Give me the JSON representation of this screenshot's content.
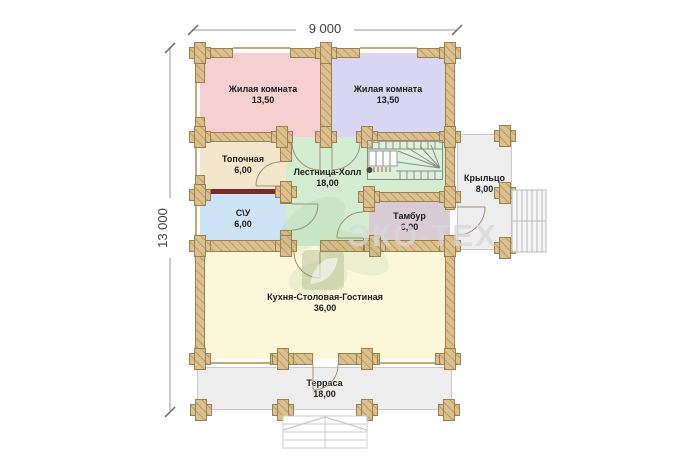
{
  "dimensions": {
    "width": "9 000",
    "height": "13 000"
  },
  "watermark": {
    "brand": "ЭКО-ТЕХ"
  },
  "rooms": [
    {
      "id": "bedroom-left",
      "name": "Жилая комната",
      "area": "13,50",
      "color": "#f6cfd1"
    },
    {
      "id": "bedroom-right",
      "name": "Жилая комната",
      "area": "13,50",
      "color": "#d9d6f3"
    },
    {
      "id": "boiler",
      "name": "Топочная",
      "area": "6,00",
      "color": "#f3e7cb"
    },
    {
      "id": "hall",
      "name": "Лестница-Холл",
      "area": "18,00",
      "color": "#d2edd0"
    },
    {
      "id": "bathroom",
      "name": "С\\У",
      "area": "6,00",
      "color": "#cde4f7"
    },
    {
      "id": "tambour",
      "name": "Тамбур",
      "area": "6,00",
      "color": "#d8cbd2"
    },
    {
      "id": "kitchen",
      "name": "Кухня-Столовая-Гостиная",
      "area": "36,00",
      "color": "#faf8d8"
    },
    {
      "id": "porch",
      "name": "Крыльцо",
      "area": "8,00",
      "color": "#ededed"
    },
    {
      "id": "terrace",
      "name": "Терраса",
      "area": "18,00",
      "color": "#ededed"
    }
  ],
  "colors": {
    "wall": "#dcc08e",
    "wall_border": "#9c7f4e",
    "partition_red": "#7a2a2a",
    "slab": "#ededed",
    "slab_border": "#c9c9c9",
    "window_line": "#c6a96f"
  }
}
